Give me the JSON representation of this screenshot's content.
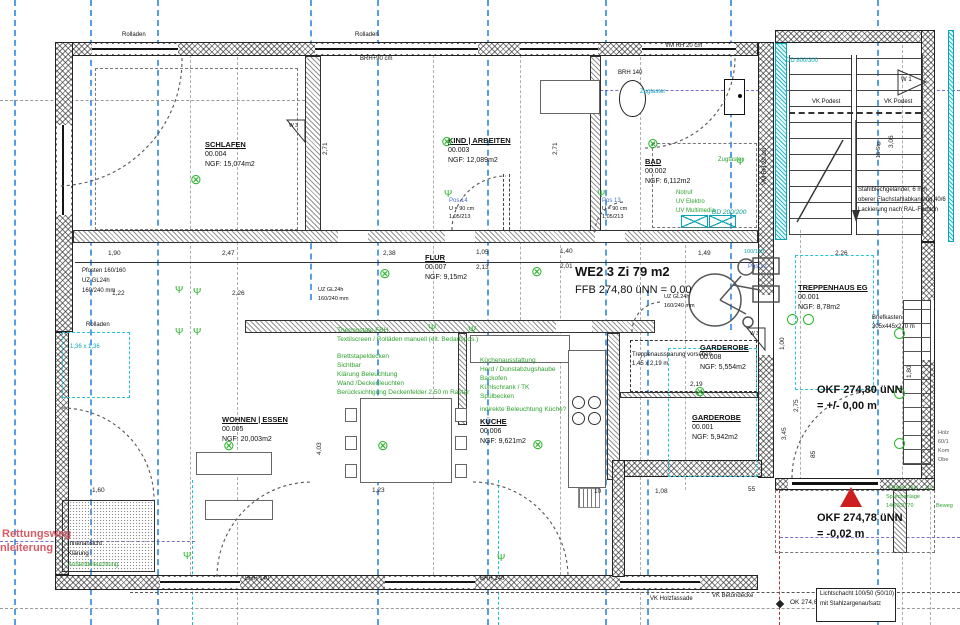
{
  "unit": {
    "title": "WE2 3 Zi 79 m2",
    "ffb": "FFB 274,80 üNN = 0,00"
  },
  "rooms": {
    "schlafen": {
      "name": "SCHLAFEN",
      "num": "00.004",
      "ngf": "NGF: 15,074m2"
    },
    "kind": {
      "name": "KIND | ARBEITEN",
      "num": "00.003",
      "ngf": "NGF: 12,089m2"
    },
    "bad": {
      "name": "BAD",
      "num": "00.002",
      "ngf": "NGF: 6,112m2"
    },
    "flur": {
      "name": "FLUR",
      "num": "00.007",
      "ngf": "NGF: 9,15m2"
    },
    "wohnen": {
      "name": "WOHNEN | ESSEN",
      "num": "00.005",
      "ngf": "NGF: 20,003m2"
    },
    "kueche": {
      "name": "KÜCHE",
      "num": "00.006",
      "ngf": "NGF: 9,621m2"
    },
    "garderobe8": {
      "name": "GARDEROBE",
      "num": "00.008",
      "ngf": "NGF: 5,554m2"
    },
    "garderobe1": {
      "name": "GARDEROBE",
      "num": "00.001",
      "ngf": "NGF: 5,942m2"
    },
    "treppenhaus": {
      "name": "TREPPENHAUS EG",
      "num": "00.001",
      "ngf": "NGF: 8,78m2"
    }
  },
  "levels": {
    "okf1a": "OKF 274,80 üNN",
    "okf1b": "= +/- 0,00 m",
    "okf2a": "OKF 274,78 üNN",
    "okf2b": "= -0,02 m",
    "okpt": "OK 274,68"
  },
  "rescue": {
    "l1": "Rettungsweg",
    "l2": "Anleiterung"
  },
  "notes": {
    "fbh1": "Thermostate FBH",
    "fbh2": "Textilscreen / Rolläden manuell (elt. Bedarfspos.)",
    "decke1": "Brettstapeldecken",
    "decke2": "Sichtbar",
    "decke3": "Klärung Beleuchtung",
    "decke4": "Wand /Deckenleuchten",
    "decke5": "Berücksichtigung Deckenfelder 2,50 m Raster",
    "k1": "Küchenausstattung",
    "k2": "Herd / Dunstabzugshaube",
    "k3": "Backofen",
    "k4": "Kühlschrank / TK",
    "k5": "Spülbecken",
    "k6": "indirekte Beleuchtung Küche?",
    "bad1": "Notruf",
    "bad2": "UV Elektro",
    "bad3": "UV Multimedia",
    "zug1": "Zugtaster",
    "zug2": "Zugtaster",
    "aus1": "Treppenaussparung vorsehen",
    "aus2": "1,45 x 2,19 m",
    "gel1": "Stahlblechgeländer, 6 mm",
    "gel2": "oberer Flachstahlabkantung 40/6",
    "gel3": "Lackierung nach RAL-Farbton",
    "brief1": "Briefkasten",
    "brief2": "305x445x270 m",
    "innen1": "Innenansicht",
    "innen2": "Klärung",
    "innen3": "Außenbeleuchtung",
    "klingel1": "Klingel- Tast",
    "klingel2": "Sprechanlage",
    "klingel3": "140/330/70",
    "holz1": "Holz",
    "holz2": "60/1",
    "holz3": "Kom",
    "holz4": "Obe",
    "kl": "KL",
    "beweg": "Beweg",
    "licht1": "Lichtschacht 100/50 (50/10)",
    "licht2": "mit Stahlzargenaufsatz",
    "pf1": "Pfosten 160/160",
    "pf2": "UZ GL24h",
    "pf3": "160/240 mm",
    "uz1a": "UZ GL24h",
    "uz1b": "160/240 mm",
    "uz2a": "UZ GL24h",
    "uz2b": "160/240 mm",
    "cdim": "1,36 x 1,36",
    "c100": "100/100"
  },
  "marks": {
    "rolladen1": "Rolladen",
    "rolladen2": "Rolladen",
    "rolladen3": "Rolladen",
    "brh90": "BRH+90 cm",
    "brh140a": "BRH 140",
    "brh140b": "BRH 140",
    "brh140c": "BRH 140",
    "vmrh1": "VM RH 20 cm",
    "vmrh2": "VM RH 20 cm",
    "bd": "BD 200/200",
    "dd": "DD 800/300",
    "vkpodest1": "VK Podest",
    "vkpodest2": "VK Podest",
    "vkholz": "VK Holzfassade",
    "vkbeton": "VK Betondecke",
    "w1": "W 1",
    "w3a": "W 3",
    "w3b": "W 3",
    "stg": "15 Stg.",
    "pos14": "Pos 14",
    "pos13": "Pos 13",
    "pos12": "Pos 12",
    "u90a": "U = 90 cm",
    "u90b": "1,05/213",
    "u90c": "U = 90 cm",
    "u90d": "1,05/213"
  },
  "dims": {
    "d1": "2,38",
    "d2": "1,05",
    "d3": "2,13",
    "d4": "1,40",
    "d5": "2,01",
    "d6": "1,49",
    "d7": "2,26",
    "d8": "1,90",
    "d9": "2,47",
    "d10": "1,22",
    "d11": "2,26",
    "d12": "2,71",
    "d13": "2,71",
    "d14": "4,03",
    "d15": "1,60",
    "d16": "1,23",
    "d17": "10",
    "d18": "1,08",
    "d19": "55",
    "d20": "2,19",
    "d21": "1,00",
    "d22": "3,45",
    "d23": "1,80",
    "d24": "85",
    "d25": "2,75",
    "d26": "3,06"
  },
  "symbols": {
    "lamp": "⊗",
    "switch": "Ψ"
  }
}
